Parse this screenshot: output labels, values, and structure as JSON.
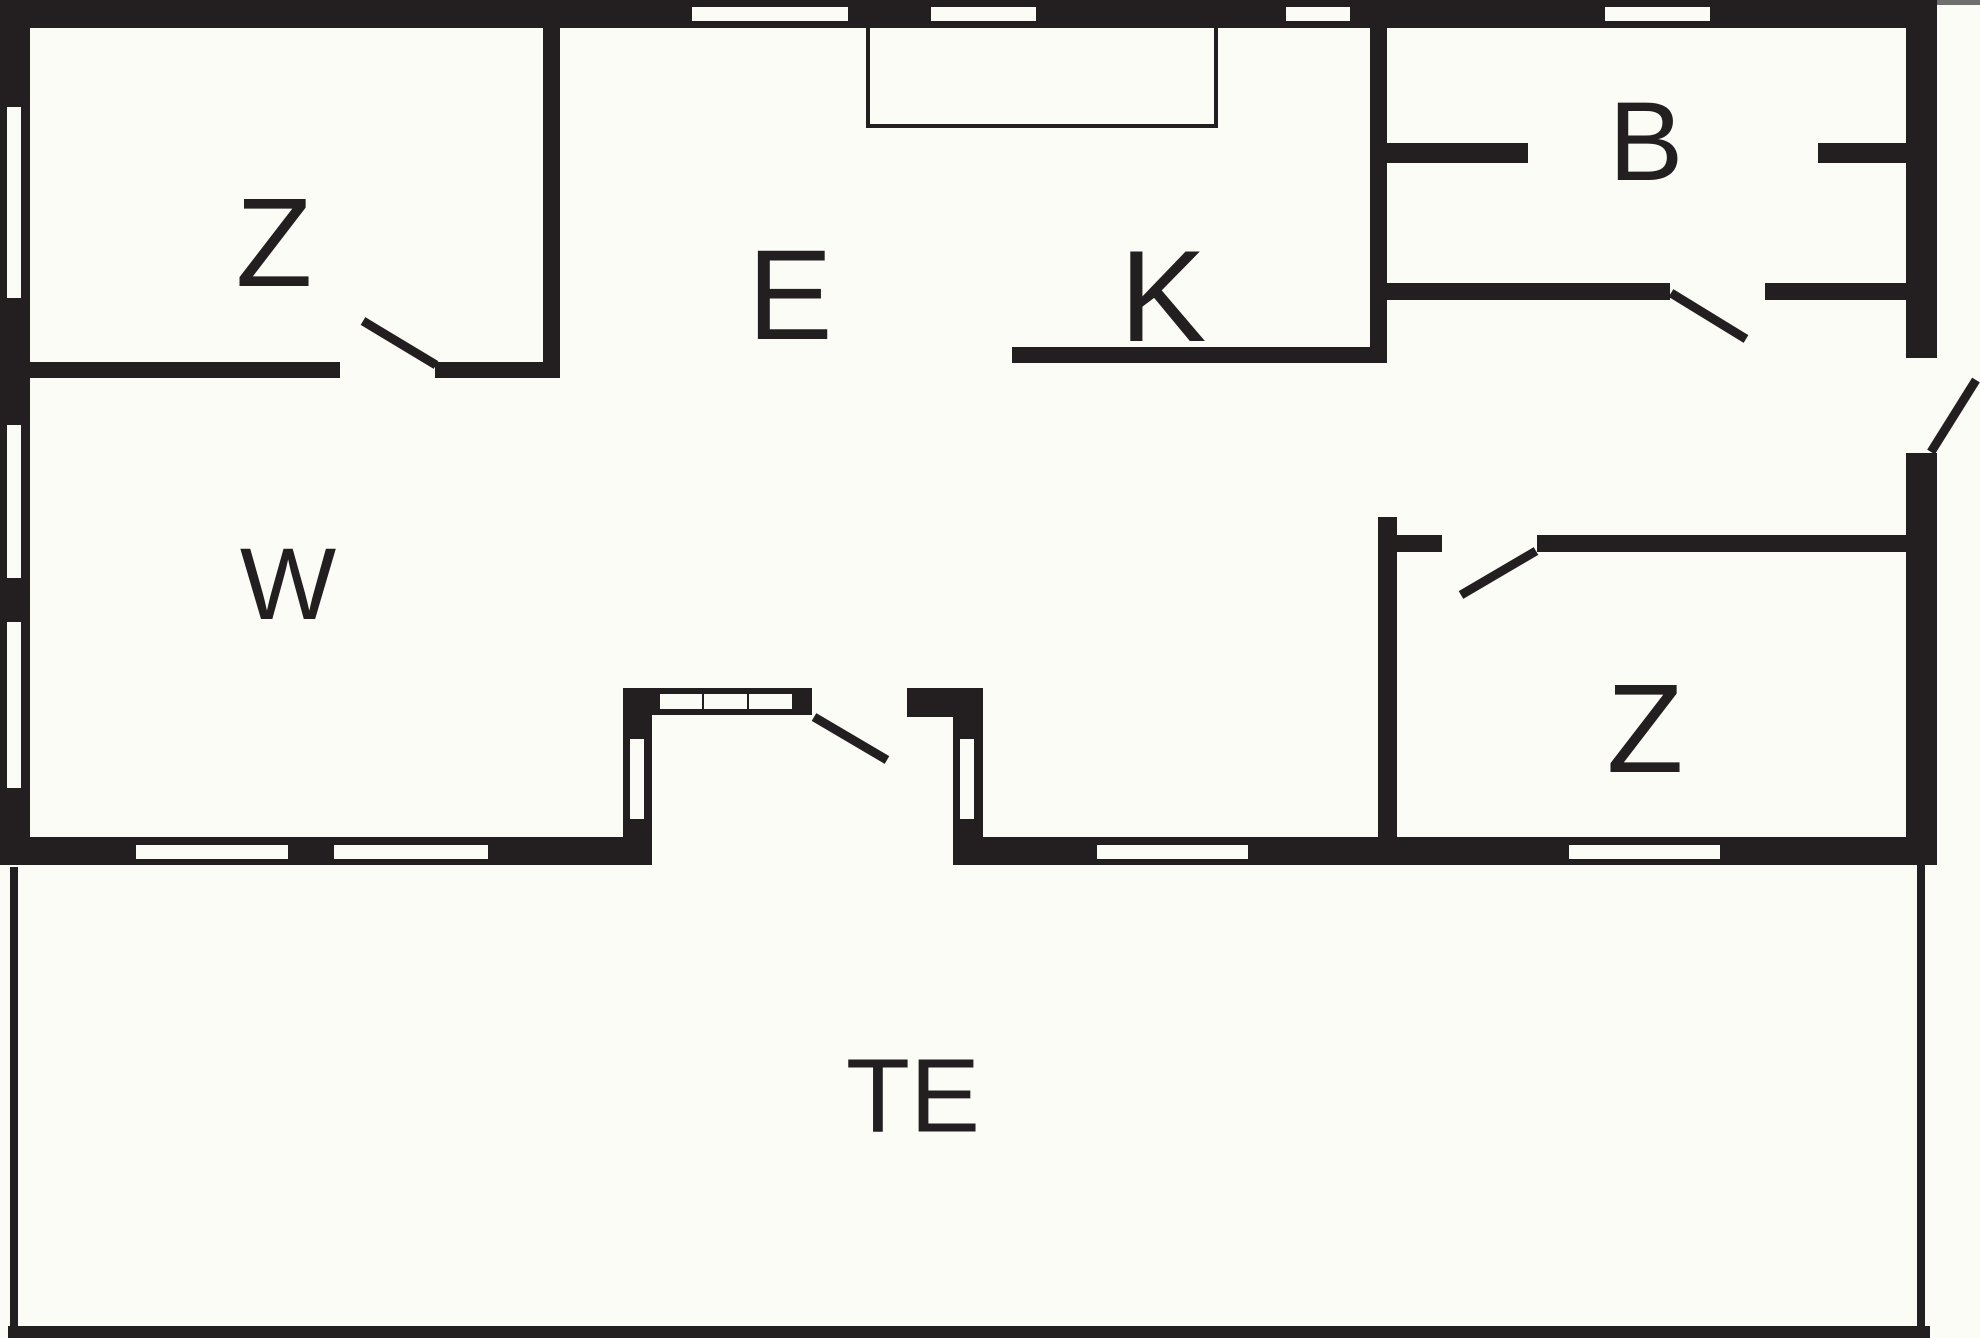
{
  "plan": {
    "type": "floor-plan",
    "colors": {
      "wall": "#231f20",
      "background": "#fcfcf7",
      "window_fill": "#fcfcf7"
    },
    "rooms": [
      {
        "id": "bedroom-top-left",
        "label": "Z"
      },
      {
        "id": "dining-hall",
        "label": "E"
      },
      {
        "id": "kitchen",
        "label": "K"
      },
      {
        "id": "bathroom",
        "label": "B"
      },
      {
        "id": "living-room",
        "label": "W"
      },
      {
        "id": "bedroom-bottom-right",
        "label": "Z"
      },
      {
        "id": "terrace",
        "label": "TE"
      }
    ]
  }
}
